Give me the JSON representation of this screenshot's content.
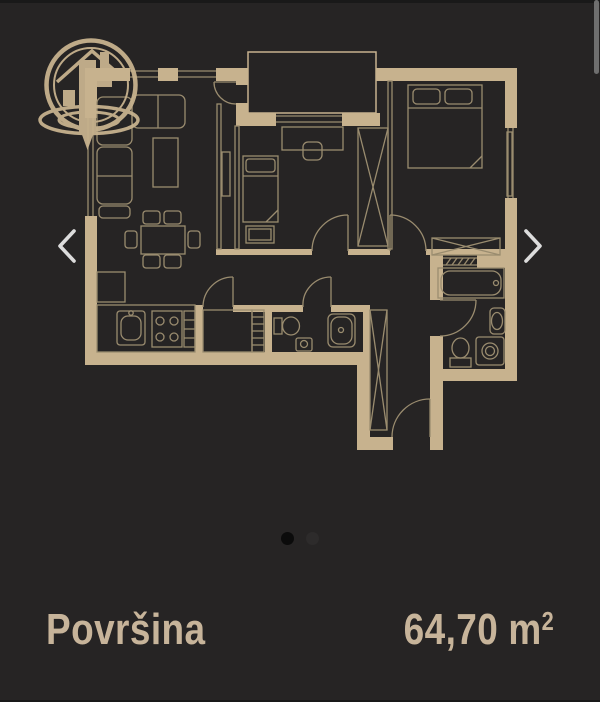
{
  "colors": {
    "bg": "#262424",
    "edge": "#191919",
    "wall": "#c7b28e",
    "line": "#9a8c6f",
    "text": "#c7b49a",
    "chevron": "#dcdcdc",
    "dot_active": "#0b0b0b",
    "dot_inactive": "#2d2b2b",
    "scrollbar": "#6f6f6f"
  },
  "logo": {
    "icon": "house-location-pin-circle-logo"
  },
  "carousel": {
    "prev_icon": "chevron-left",
    "next_icon": "chevron-right",
    "dots": [
      {
        "active": true
      },
      {
        "active": false
      }
    ]
  },
  "floor_plan": {
    "alt": "Apartment floor plan drawing"
  },
  "details": {
    "area_label": "Površina",
    "area_value": "64,70",
    "area_unit_base": "m",
    "area_unit_exponent": "2"
  }
}
